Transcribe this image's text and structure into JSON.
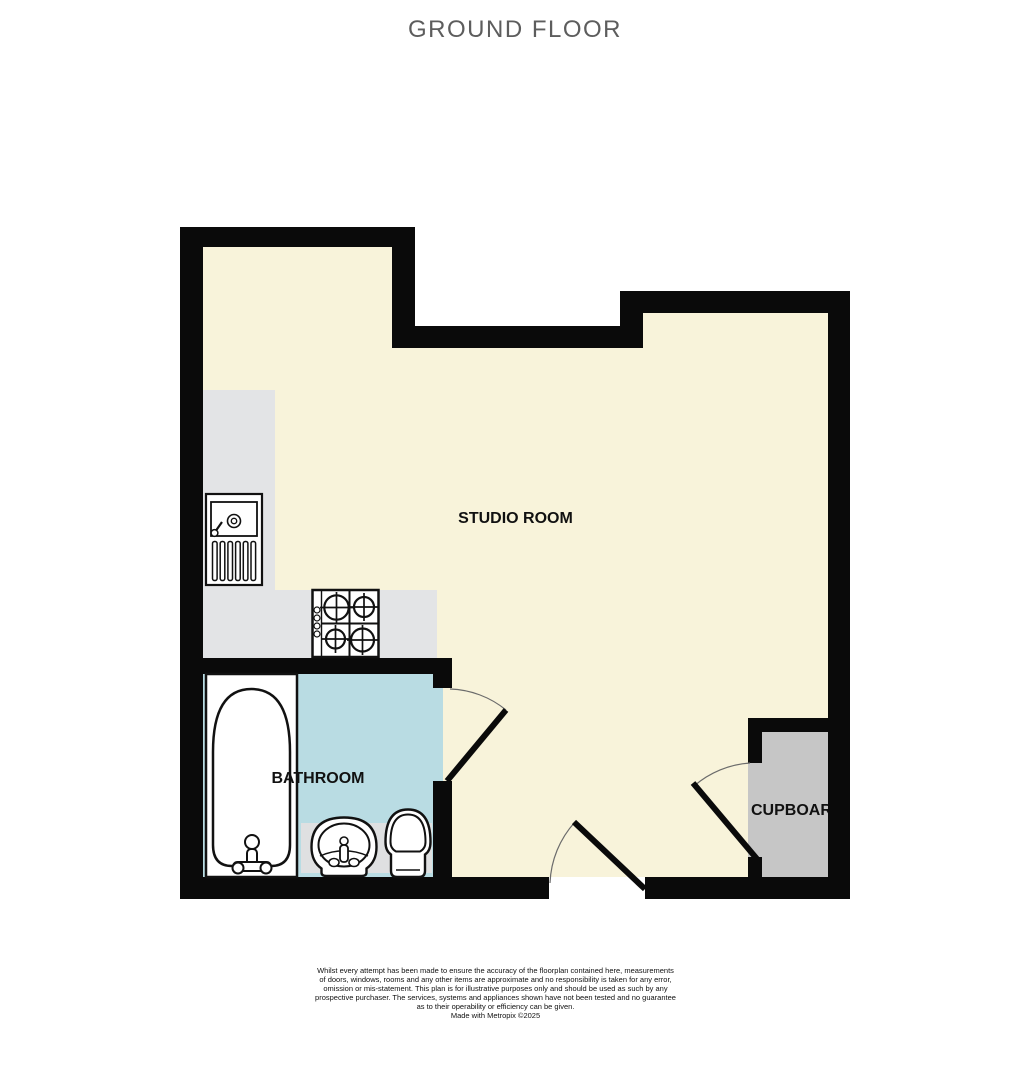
{
  "title": "GROUND FLOOR",
  "plan": {
    "rooms": {
      "studio": {
        "label": "STUDIO ROOM"
      },
      "bathroom": {
        "label": "BATHROOM"
      },
      "cupboard": {
        "label": "CUPBOARD"
      }
    },
    "icons": [
      "kitchen-sink-icon",
      "hob-icon",
      "bathtub-icon",
      "pedestal-basin-icon",
      "toilet-icon",
      "door-swing-icon"
    ]
  },
  "colors": {
    "wall": "#0a0a0a",
    "floor": "#f8f3da",
    "kitchen_counter": "#e3e4e6",
    "bathroom_floor": "#b9dce3",
    "bathroom_unit_strip": "#dfe0e1",
    "cupboard_floor": "#c6c6c6",
    "fixture_outline": "#111111",
    "door_arc": "#6b6b6b",
    "title_text": "#5d5d5d",
    "label_text": "#111111"
  },
  "disclaimer": {
    "lines": [
      "Whilst every attempt has been made to ensure the accuracy of the floorplan contained here, measurements",
      "of doors, windows, rooms and any other items are approximate and no responsibility is taken for any error,",
      "omission or mis-statement. This plan is for illustrative purposes only and should be used as such by any",
      "prospective purchaser. The services, systems and appliances shown have not been tested and no guarantee",
      "as to their operability or efficiency can be given."
    ]
  },
  "credit": "Made with Metropix ©2025"
}
